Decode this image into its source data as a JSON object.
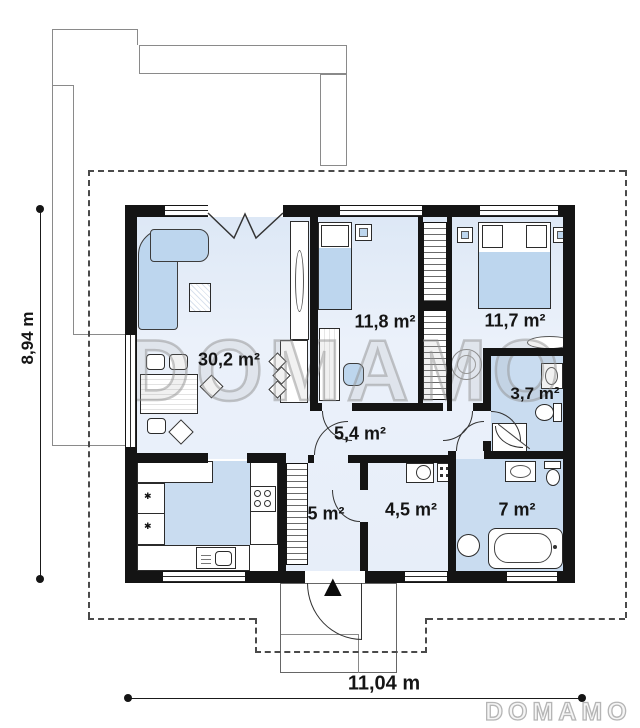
{
  "plan": {
    "watermark_text": "DOMAMO",
    "brand": "DOMAMO",
    "dimension_height_label": "8,94 m",
    "dimension_width_label": "11,04 m",
    "rooms": [
      {
        "name": "living-room",
        "area_label": "30,2 m²"
      },
      {
        "name": "bedroom-1",
        "area_label": "11,8 m²"
      },
      {
        "name": "bedroom-2",
        "area_label": "11,7 m²"
      },
      {
        "name": "bathroom-small",
        "area_label": "3,7 m²"
      },
      {
        "name": "hall",
        "area_label": "5,4 m²"
      },
      {
        "name": "vestibule",
        "area_label": "5 m²"
      },
      {
        "name": "utility-room",
        "area_label": "4,5 m²"
      },
      {
        "name": "bathroom-large",
        "area_label": "7 m²"
      }
    ],
    "icons": {
      "entrance_arrow": "▲",
      "freezer_star": "✱"
    },
    "colors": {
      "wall": "#141414",
      "floor_light": "#e9f0fa",
      "floor_blue": "#c9dcf0",
      "furniture_blue": "#bdd6ee",
      "watermark_gray": "#a8a8a8"
    }
  }
}
